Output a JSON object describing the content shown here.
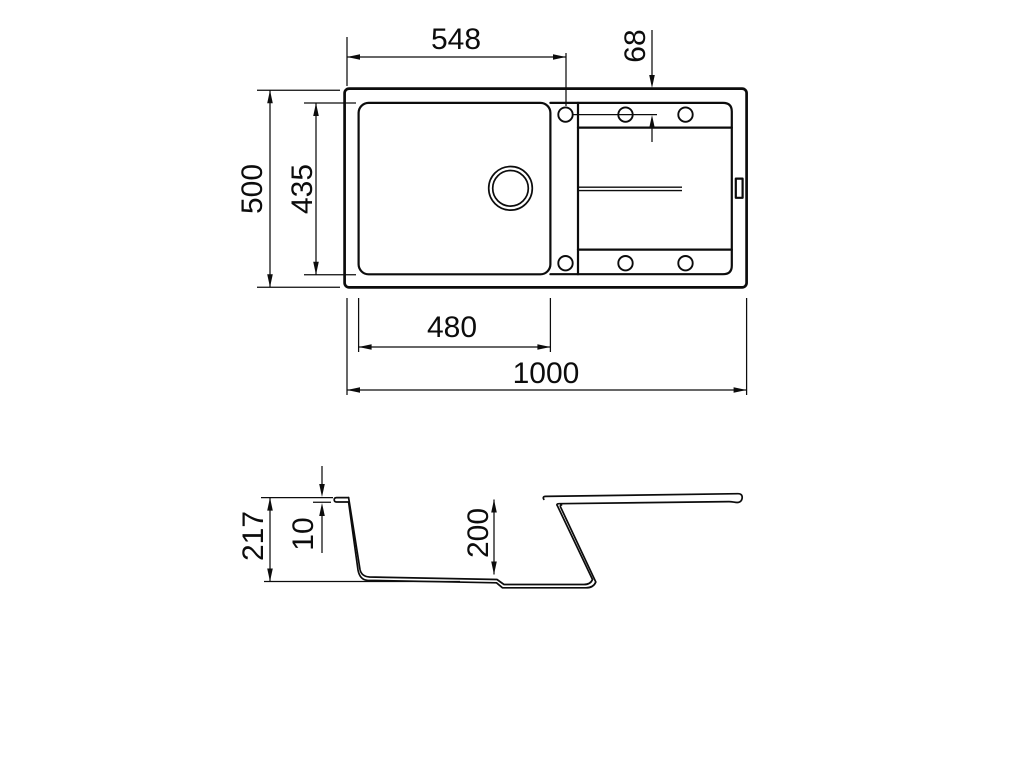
{
  "drawing": {
    "type": "technical-dimension-drawing",
    "subject": "kitchen-sink-with-drainboard",
    "units_scale": "millimeters",
    "line_color": "#0c0c0c",
    "background_color": "#ffffff"
  },
  "top_view": {
    "dim_cutout_width": "548",
    "dim_hole_offset": "68",
    "dim_overall_depth": "500",
    "dim_bowl_depth": "435",
    "dim_bowl_width": "480",
    "dim_overall_length": "1000",
    "tap_hole_count": "6"
  },
  "side_view": {
    "dim_overall_height": "217",
    "dim_rim_thickness": "10",
    "dim_bowl_inner_depth": "200"
  }
}
